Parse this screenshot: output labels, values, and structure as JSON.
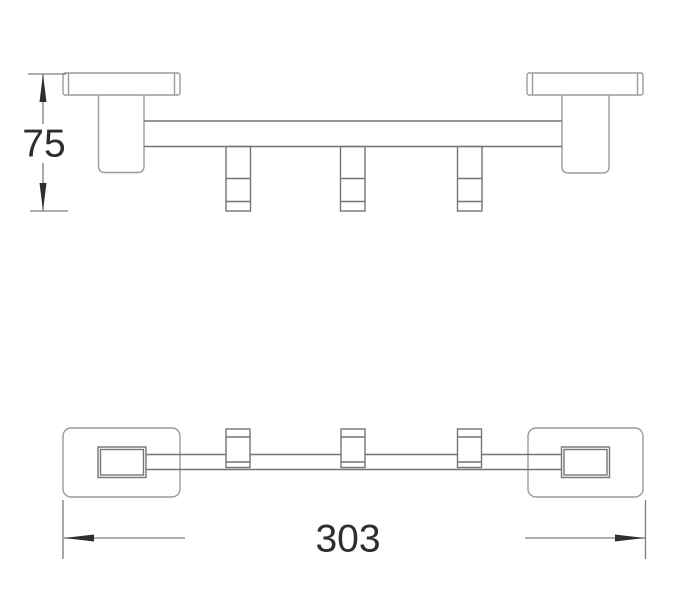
{
  "title": "towel-hook-rail-technical-drawing",
  "colors": {
    "background": "#ffffff",
    "outline": "#9a9a9a",
    "detail": "#757575",
    "dimension_line": "#7d7d7d",
    "dimension_text": "#2e2e2e"
  },
  "dimensions": {
    "height_label": "75",
    "length_label": "303"
  },
  "product": {
    "hook_count": 3,
    "views": [
      "side-elevation",
      "plan-view"
    ]
  }
}
